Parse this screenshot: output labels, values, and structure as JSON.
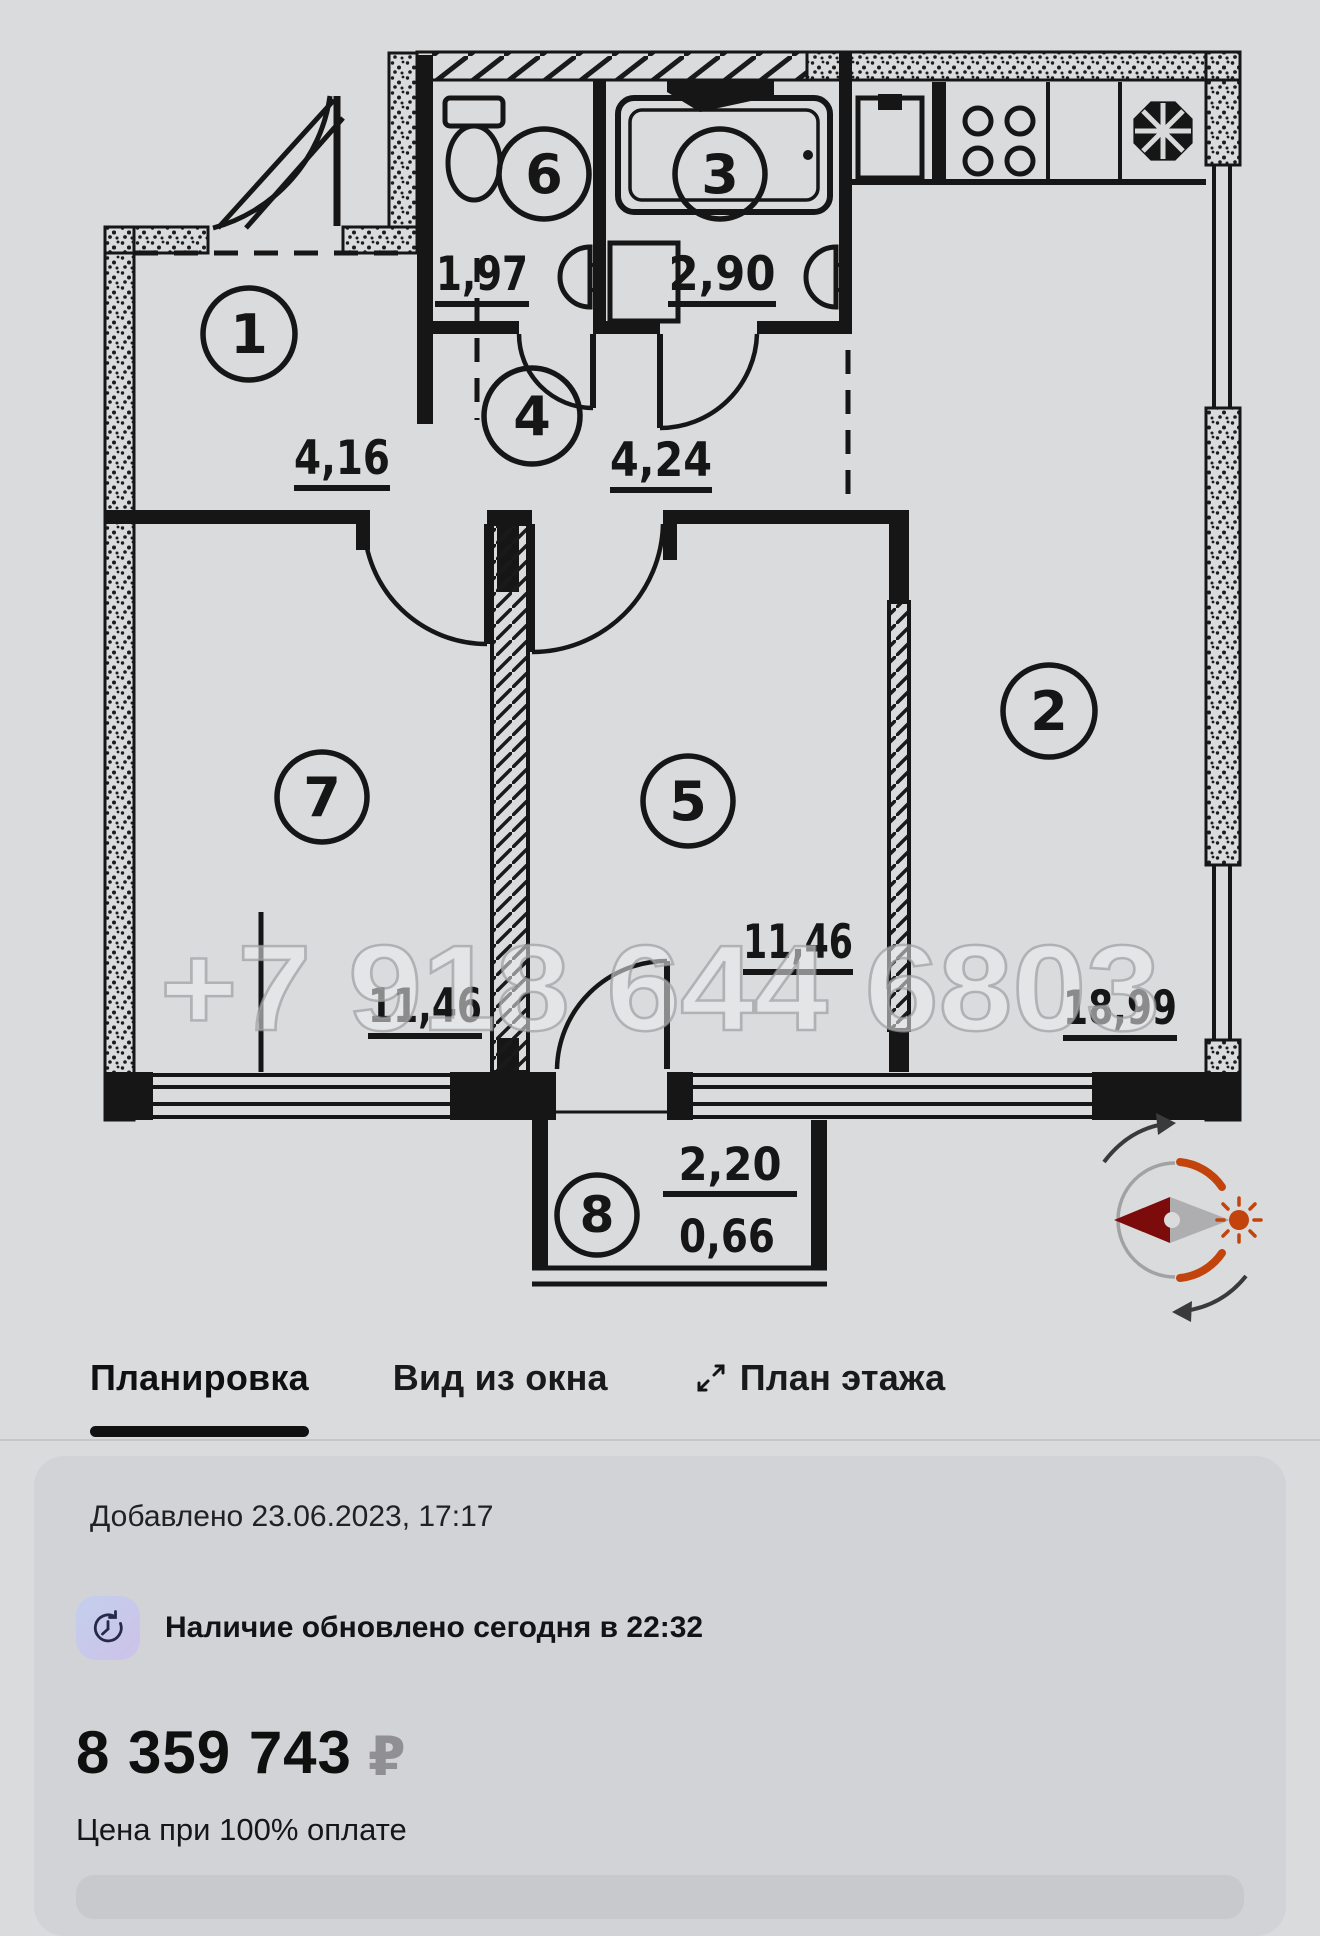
{
  "floorplan": {
    "watermark": "+7 918 644 6803",
    "rooms": [
      {
        "n": "1",
        "area": "4,16"
      },
      {
        "n": "2",
        "area": "18,99"
      },
      {
        "n": "3",
        "area": "2,90"
      },
      {
        "n": "4",
        "area": "4,24"
      },
      {
        "n": "5",
        "area": "11,46"
      },
      {
        "n": "6",
        "area": "1,97"
      },
      {
        "n": "7",
        "area": "11,46"
      },
      {
        "n": "8",
        "area_upper": "2,20",
        "area_lower": "0,66"
      }
    ],
    "colors": {
      "line": "#161616",
      "compass_orange": "#c2430c",
      "compass_dark_red": "#7c0b0b",
      "compass_gray": "#a2a2a5",
      "watermark_gray": "#9e9ea2"
    }
  },
  "tabs": {
    "items": [
      {
        "label": "Планировка",
        "active": true
      },
      {
        "label": "Вид из окна",
        "active": false
      },
      {
        "label": "План этажа",
        "active": false,
        "icon": "expand-arrows-icon"
      }
    ]
  },
  "listing": {
    "added": "Добавлено 23.06.2023, 17:17",
    "availability": "Наличие обновлено сегодня в 22:32",
    "price": "8 359 743",
    "currency": "₽",
    "price_note": "Цена при 100% оплате"
  }
}
